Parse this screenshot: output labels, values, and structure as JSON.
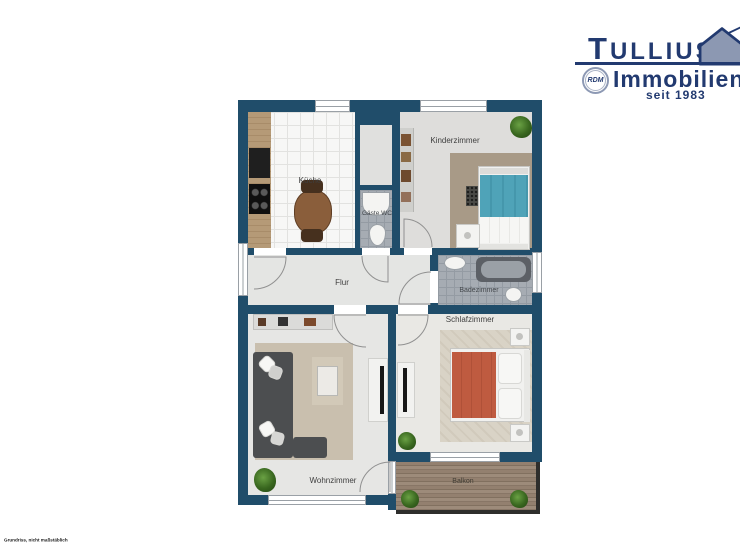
{
  "logo": {
    "brand": "Tullius",
    "division": "Immobilien",
    "badge": "RDM",
    "since": "seit 1983",
    "colors": {
      "navy": "#223a70",
      "house_fill": "#8c98b2"
    }
  },
  "plan": {
    "labels": {
      "kueche": "Küche",
      "gaeste_wc": "Gäste WC",
      "kinderzimmer": "Kinderzimmer",
      "flur": "Flur",
      "badezimmer": "Badezimmer",
      "schlafzimmer": "Schlafzimmer",
      "wohnzimmer": "Wohnzimmer",
      "balkon": "Balkon"
    },
    "colors": {
      "wall": "#204d6a",
      "bed_teal": "#4fa3b8",
      "bed_terracotta": "#bf5b40",
      "sofa_gray": "#4c4e50"
    }
  },
  "footer": {
    "disclaimer": "Grundriss, nicht maßstäblich"
  }
}
